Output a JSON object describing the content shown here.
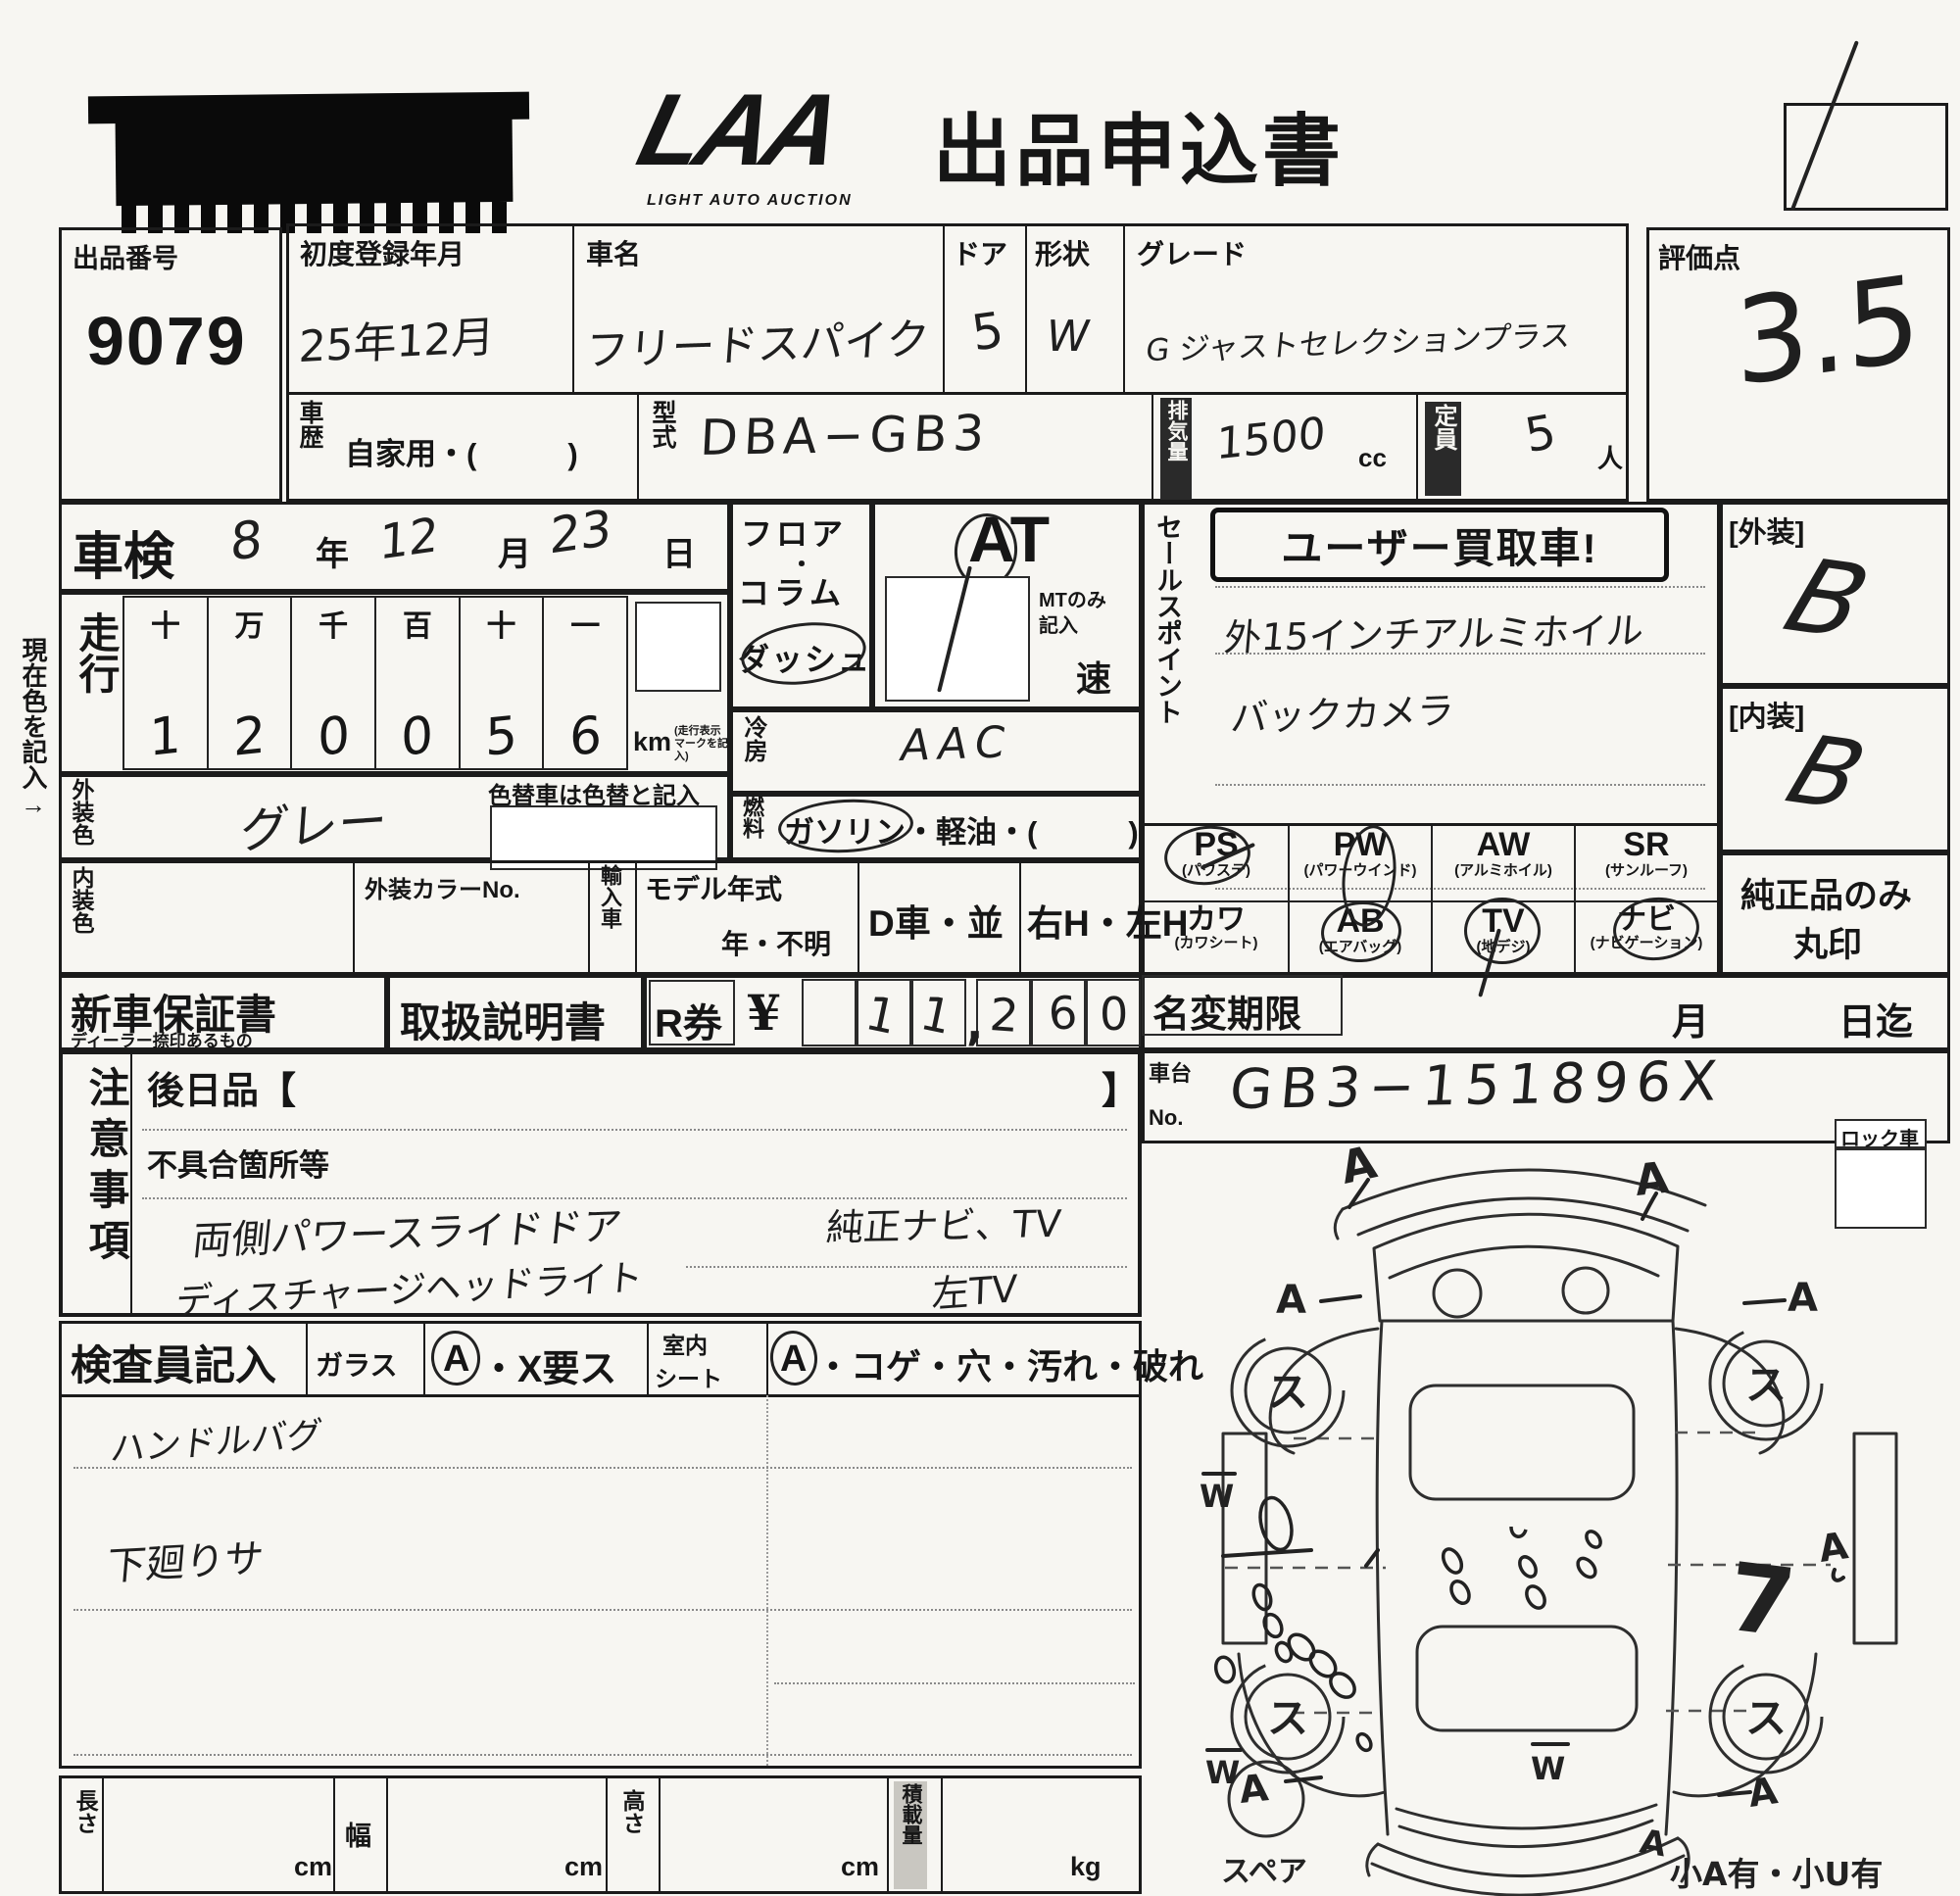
{
  "header": {
    "logo": "LAA",
    "logo_sub": "LIGHT AUTO AUCTION",
    "title": "出品申込書",
    "corner_mark": "1"
  },
  "top": {
    "lot_label": "出品番号",
    "lot_number": "9079",
    "first_reg_label": "初度登録年月",
    "first_reg_value": "25年12月",
    "car_name_label": "車名",
    "car_name_value": "フリードスパイク",
    "doors_label": "ドア",
    "doors_value": "5",
    "shape_label": "形状",
    "shape_value": "W",
    "grade_label": "グレード",
    "grade_value": "G ジャストセレクションプラス",
    "score_label": "評価点",
    "score_value": "3.5",
    "history_label": "車歴",
    "history_value": "自家用・(　　　)",
    "model_label": "型式",
    "model_value": "DBA−GB3",
    "disp_label": "排気量",
    "disp_value": "1500",
    "disp_unit": "cc",
    "cap_label": "定員",
    "cap_value": "5",
    "cap_unit": "人"
  },
  "shaken": {
    "label": "車検",
    "year": "8",
    "y": "年",
    "month": "12",
    "m": "月",
    "day": "23",
    "d": "日"
  },
  "mileage": {
    "label": "走行",
    "h0": "十",
    "h1": "万",
    "h2": "千",
    "h3": "百",
    "h4": "十",
    "h5": "一",
    "d0": "1",
    "d1": "2",
    "d2": "0",
    "d3": "0",
    "d4": "5",
    "d5": "6",
    "unit": "km",
    "unit_note": "(走行表示マークを記入)"
  },
  "colors": {
    "ext_label": "外装色",
    "ext_value": "グレー",
    "change_note": "色替車は色替と記入",
    "int_label": "内装色",
    "color_no_label": "外装カラーNo.",
    "import_label": "輸入車",
    "model_year_label": "モデル年式",
    "model_year_value": "年・不明"
  },
  "drivetrain": {
    "floor": "フロア",
    "dot": "・",
    "column": "コラム",
    "dash": "ダッシュ",
    "at": "AT",
    "mt_note1": "MTのみ",
    "mt_note2": "記入",
    "speed": "速",
    "ac_label": "冷房",
    "ac_value": "AAC",
    "fuel_label": "燃料",
    "fuel_value": "ガソリン・軽油・(　　　)",
    "dealer": "D車・並",
    "handle": "右H・左H"
  },
  "sales": {
    "label": "セールスポイント",
    "badge": "ユーザー買取車!",
    "line1": "外15インチアルミホイル",
    "line2": "バックカメラ"
  },
  "options": {
    "ps": "PS",
    "ps_sub": "(パワステ)",
    "pw": "PW",
    "pw_sub": "(パワーウインド)",
    "aw": "AW",
    "aw_sub": "(アルミホイル)",
    "sr": "SR",
    "sr_sub": "(サンルーフ)",
    "kawa": "カワ",
    "kawa_sub": "(カワシート)",
    "ab": "AB",
    "ab_sub": "(エアバッグ)",
    "tv": "TV",
    "tv_sub": "(地デジ)",
    "navi": "ナビ",
    "navi_sub": "(ナビゲーション)",
    "marked": [
      "PS",
      "PW",
      "AB",
      "TV",
      "ナビ"
    ],
    "genuine_note1": "純正品のみ",
    "genuine_note2": "丸印"
  },
  "condition": {
    "ext_label": "[外装]",
    "ext_grade": "B",
    "int_label": "[内装]",
    "int_grade": "B"
  },
  "docs": {
    "warranty": "新車保証書",
    "warranty_sub": "ディーラー捺印あるもの",
    "manual": "取扱説明書",
    "rticket": "R券",
    "yen": "¥",
    "a0": "",
    "a1": "1",
    "a2": "1",
    "comma": ",",
    "a3": "2",
    "a4": "6",
    "a5": "0"
  },
  "namechange": {
    "label": "名変期限",
    "month": "月",
    "until": "日迄"
  },
  "chassis": {
    "label1": "車台",
    "label2": "No.",
    "value": "GB3−151896X"
  },
  "lock_label": "ロック車",
  "notes": {
    "label": "注意事項",
    "later": "後日品【",
    "bracket": "】",
    "defects": "不具合箇所等",
    "hw1": "両側パワースライドドア",
    "hw2": "ディスチャージヘッドライト",
    "hw3": "純正ナビ、TV",
    "hw4": "左TV"
  },
  "inspector": {
    "label": "検査員記入",
    "glass": "ガラス",
    "glass_a": "A",
    "glass_rest": "・X要ス",
    "seat1": "室内",
    "seat2": "シート",
    "seat_a": "A",
    "seat_rest": "・コゲ・穴・汚れ・破れ",
    "hw1": "ハンドルバグ",
    "hw2": "下廻りサ"
  },
  "dims": {
    "length": "長さ",
    "width": "幅",
    "height": "高さ",
    "load": "積載量",
    "cm": "cm",
    "kg": "kg"
  },
  "margin_note": "現在色を記入→",
  "diagram": {
    "wheel": "ス",
    "a": "A",
    "w": "W",
    "seven": "7",
    "spare": "スペア",
    "small_note": "小A有・小U有"
  }
}
